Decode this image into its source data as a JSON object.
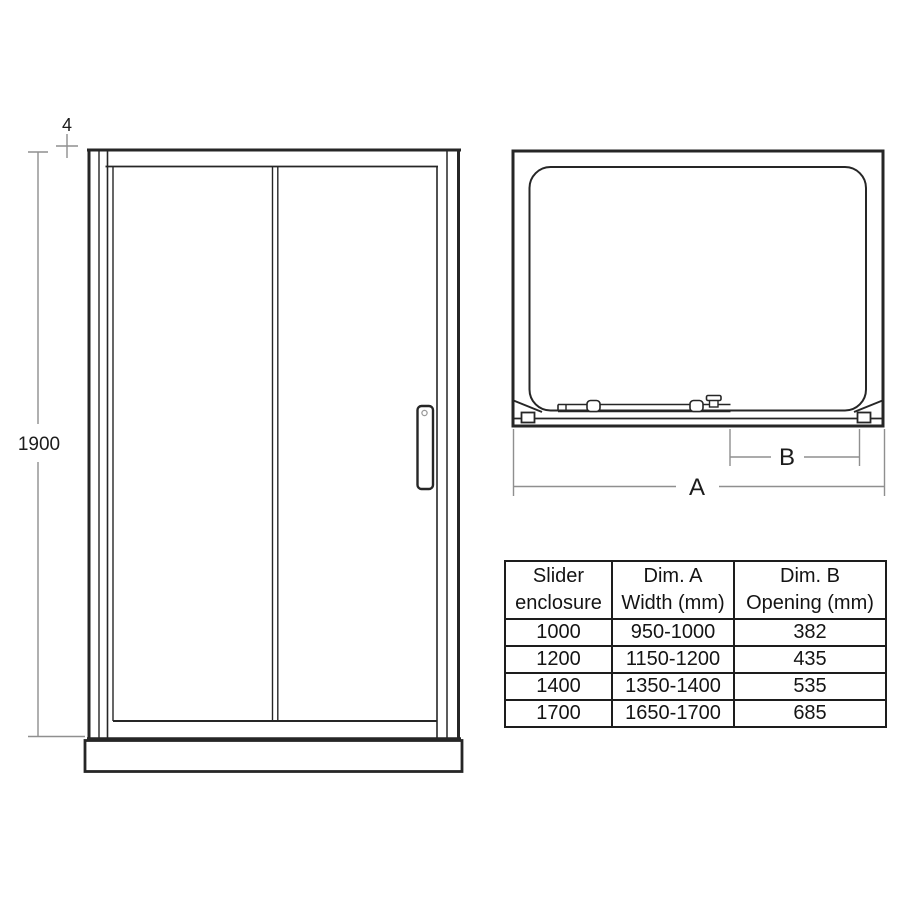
{
  "colors": {
    "line_dark": "#262626",
    "dimension_gray": "#8f8f8f",
    "background": "#ffffff",
    "text": "#1c1c1c"
  },
  "front_view": {
    "height_label": "1900",
    "top_gap_label": "4"
  },
  "plan_view": {
    "width_label": "A",
    "opening_label": "B"
  },
  "table": {
    "headers": [
      {
        "line1": "Slider",
        "line2": "enclosure"
      },
      {
        "line1": "Dim. A",
        "line2": "Width (mm)"
      },
      {
        "line1": "Dim. B",
        "line2": "Opening (mm)"
      }
    ],
    "rows": [
      [
        "1000",
        "950-1000",
        "382"
      ],
      [
        "1200",
        "1150-1200",
        "435"
      ],
      [
        "1400",
        "1350-1400",
        "535"
      ],
      [
        "1700",
        "1650-1700",
        "685"
      ]
    ]
  }
}
